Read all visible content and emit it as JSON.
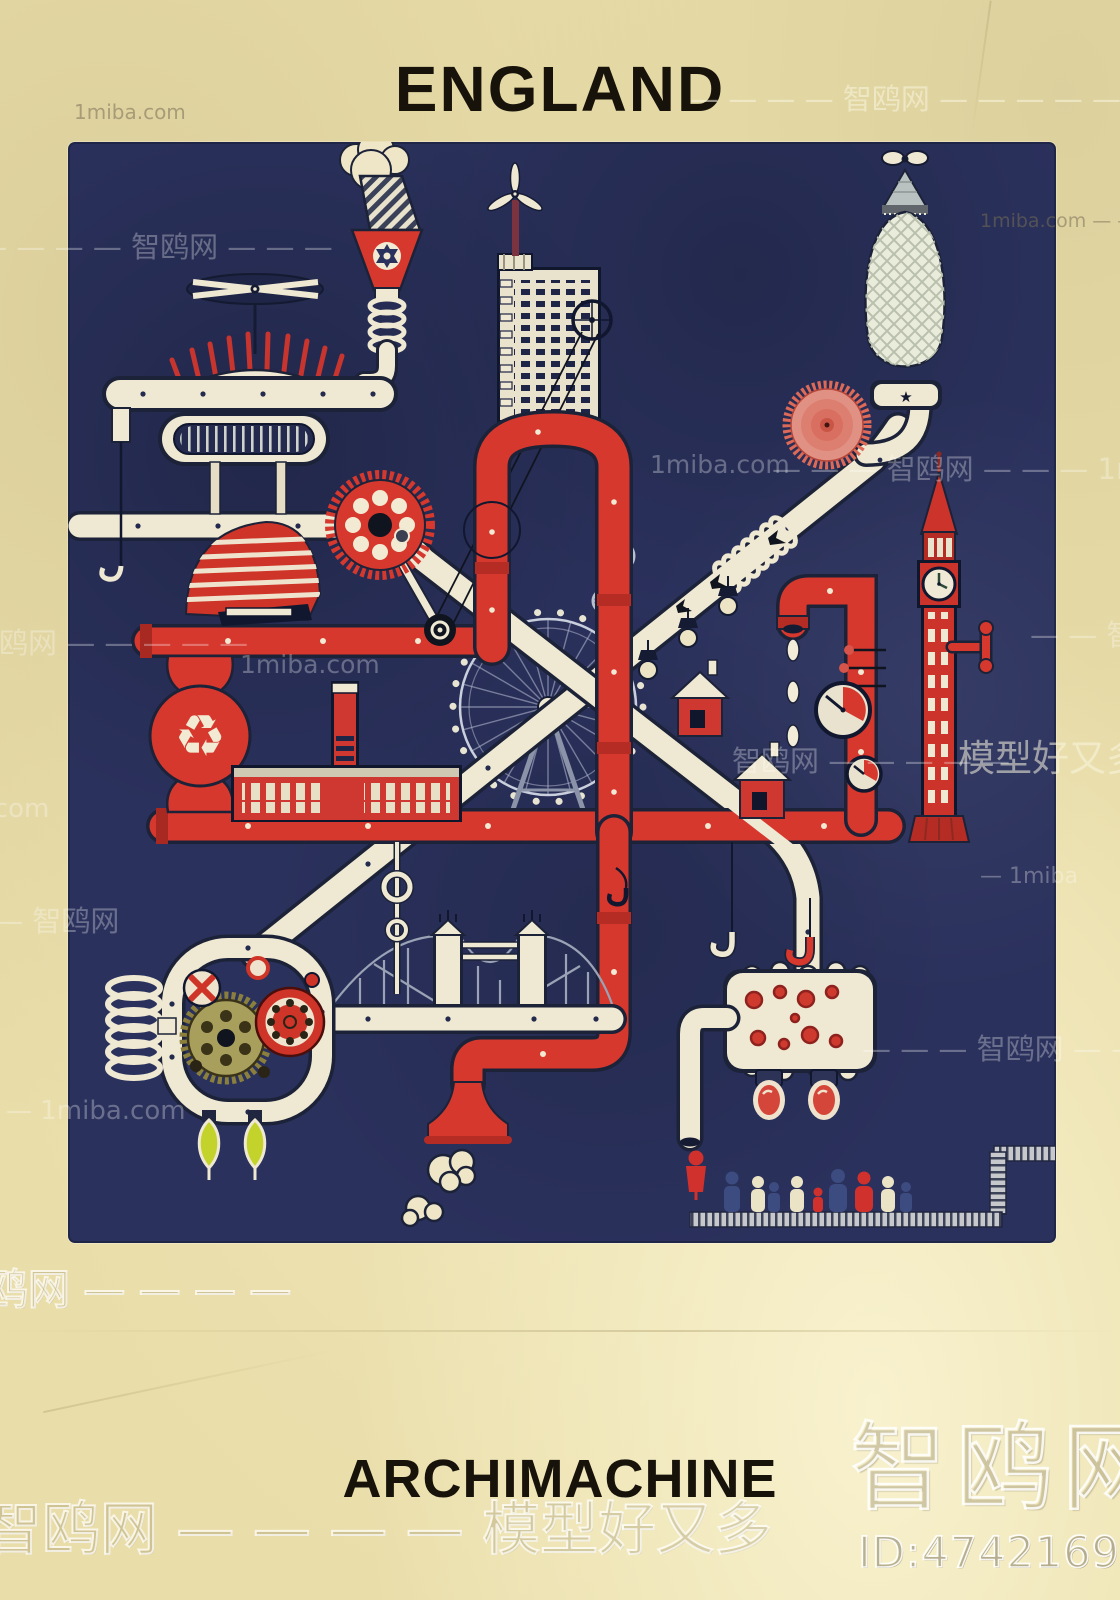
{
  "poster": {
    "title": "ENGLAND",
    "subtitle": "ARCHIMACHINE"
  },
  "icons": {
    "recycle": "♻",
    "star": "★"
  },
  "colors": {
    "paper": "#e9dda9",
    "panel_navy": "#2a315c",
    "machine_red": "#d6382e",
    "machine_cream": "#efe8d2",
    "outline_dark": "#151b33",
    "drop_green": "#c3d32b",
    "gear_olive": "#a89f5c",
    "cable_gray": "#9aa3b5"
  },
  "watermarks": {
    "site_cn": "智鸥网",
    "site_en": "1miba.com",
    "store_cn": "模型好又多",
    "id_text": "ID:474216943",
    "items": [
      {
        "text": "1miba.com"
      },
      {
        "text": "— — — — 智鸥网 — — — — — 1mi"
      },
      {
        "text": "1miba.com — —"
      },
      {
        "text": "— — — — — 智鸥网 — — —"
      },
      {
        "text": "1miba.com"
      },
      {
        "text": "— — — 智鸥网 — — — 1m"
      },
      {
        "text": "智鸥网 — — — — —"
      },
      {
        "text": "— — 智"
      },
      {
        "text": "1miba.com"
      },
      {
        "text": "智鸥网 — — — — —"
      },
      {
        "text": "模型好又多"
      },
      {
        "text": "1miba.com"
      },
      {
        "text": "— 1miba"
      },
      {
        "text": "— — 智鸥网"
      },
      {
        "text": "— — — 智鸥网 — —"
      },
      {
        "text": "— 1miba.com"
      },
      {
        "text": "鸥网 — — — —"
      },
      {
        "text": "智鸥网"
      },
      {
        "text": "ID:474216943"
      },
      {
        "text": "智鸥网 — — — — 模型好又多"
      }
    ]
  }
}
